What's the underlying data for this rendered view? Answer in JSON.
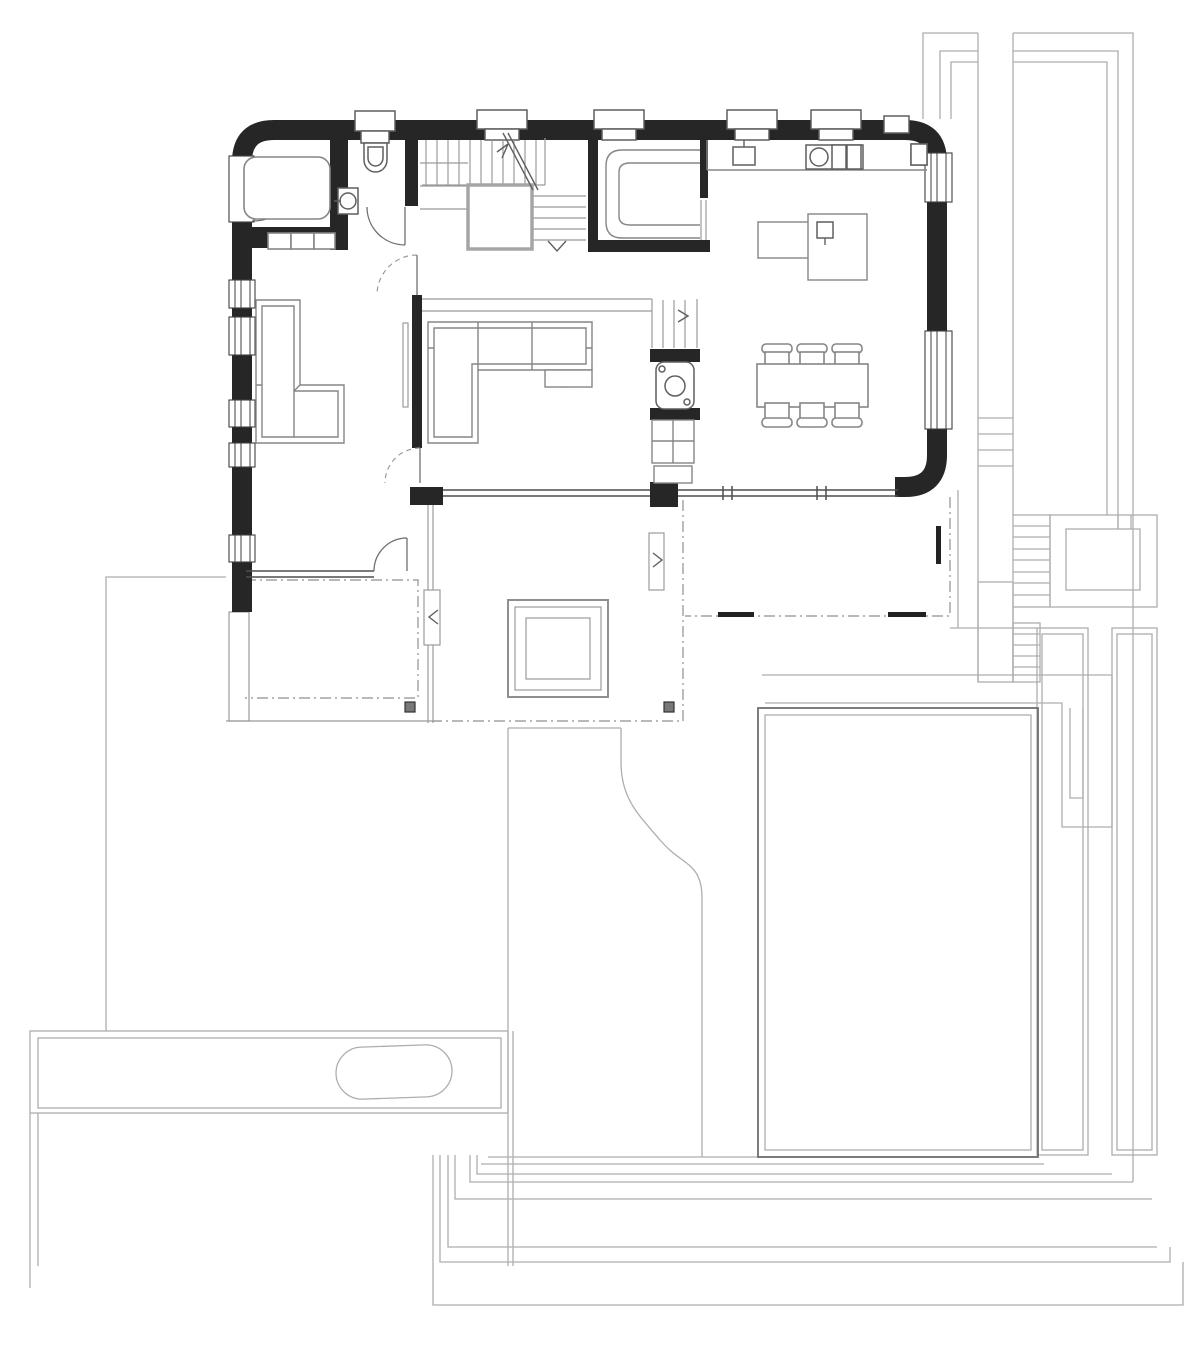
{
  "drawing": {
    "kind": "architectural-floor-plan",
    "storey": "ground-floor",
    "visible_text": []
  },
  "colors": {
    "background": "#ffffff",
    "wall": "#262626",
    "furniture_line": "#858585",
    "fixture_line": "#5f5f5f",
    "site_line": "#aeaeae",
    "thin_line": "#9b9b9b",
    "dashdot_line": "#8f8f8f",
    "glass_line": "#4f4f4f",
    "stair_void_border": "#a5a5a5",
    "drain_fill": "#787878"
  },
  "features": [
    "entrance-room-with-mat",
    "wc-with-toilet-and-basin",
    "u-shaped-staircase-with-void",
    "pantry-with-counter",
    "kitchen-counter-with-sink-and-hob",
    "kitchen-island-with-sink",
    "dining-table-with-six-chairs",
    "utility-wc",
    "living-room-corner-sofa",
    "left-room-corner-sofa",
    "left-terrace",
    "central-terrace-with-skylight",
    "right-terrace",
    "exterior-stairs",
    "walled-garden-courtyard",
    "pool",
    "lawn-with-curved-edge",
    "driveway-with-vehicle",
    "nested-retaining-walls",
    "property-boundary",
    "floor-drains"
  ]
}
